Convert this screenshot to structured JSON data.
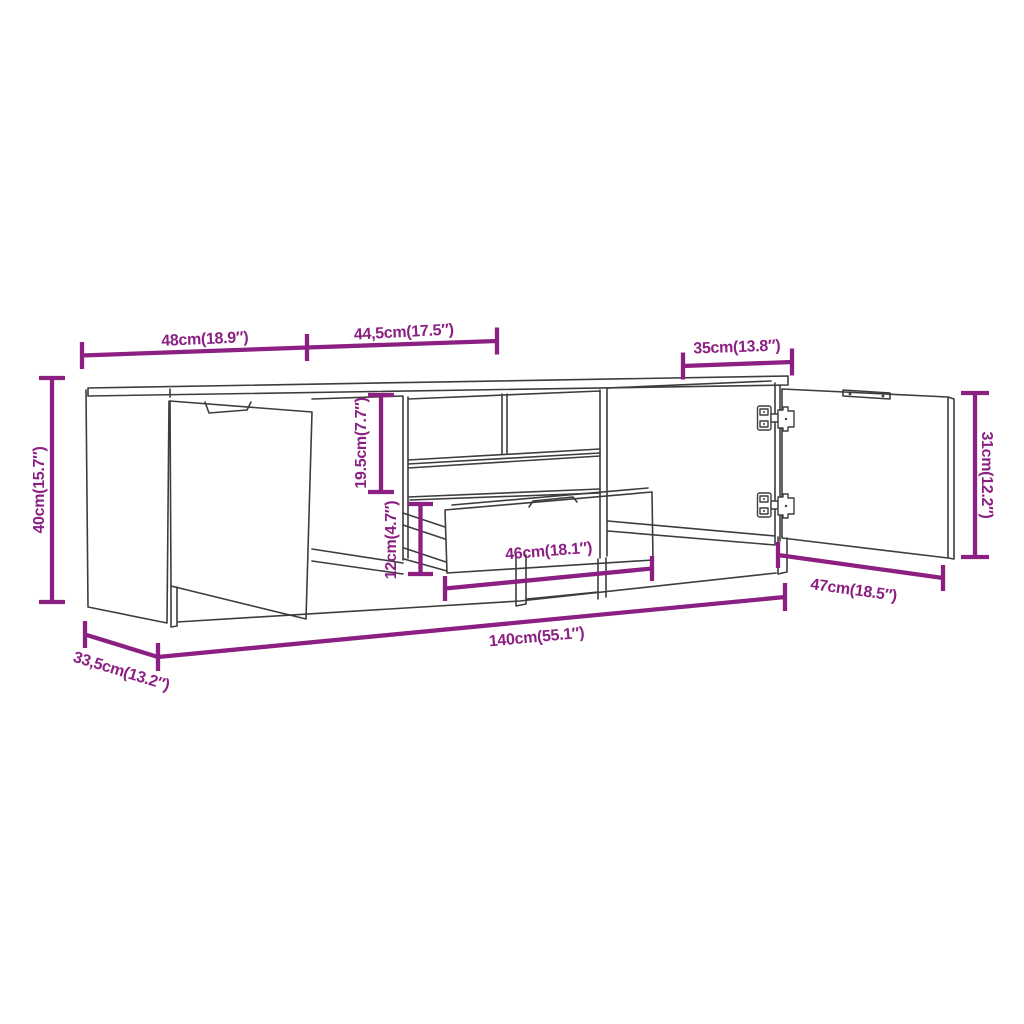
{
  "diagram": {
    "kind": "furniture-dimension-diagram",
    "subject": "TV cabinet with two doors and pull-out drawer",
    "accent_color": "#8C2082",
    "line_color": "#3d3d3d",
    "background_color": "#ffffff",
    "dims": {
      "left_section_width": {
        "label": "48cm(18.9″)"
      },
      "middle_section_width": {
        "label": "44,5cm(17.5″)"
      },
      "right_door_width": {
        "label": "35cm(13.8″)"
      },
      "overall_height": {
        "label": "40cm(15.7″)"
      },
      "upper_compartment_height": {
        "label": "19.5cm(7.7″)"
      },
      "lower_compartment_height": {
        "label": "12cm(4.7″)"
      },
      "drawer_width": {
        "label": "46cm(18.1″)"
      },
      "door_height": {
        "label": "31cm(12.2″)"
      },
      "open_door_width": {
        "label": "47cm(18.5″)"
      },
      "overall_width": {
        "label": "140cm(55.1″)"
      },
      "overall_depth": {
        "label": "33,5cm(13.2″)"
      }
    }
  }
}
